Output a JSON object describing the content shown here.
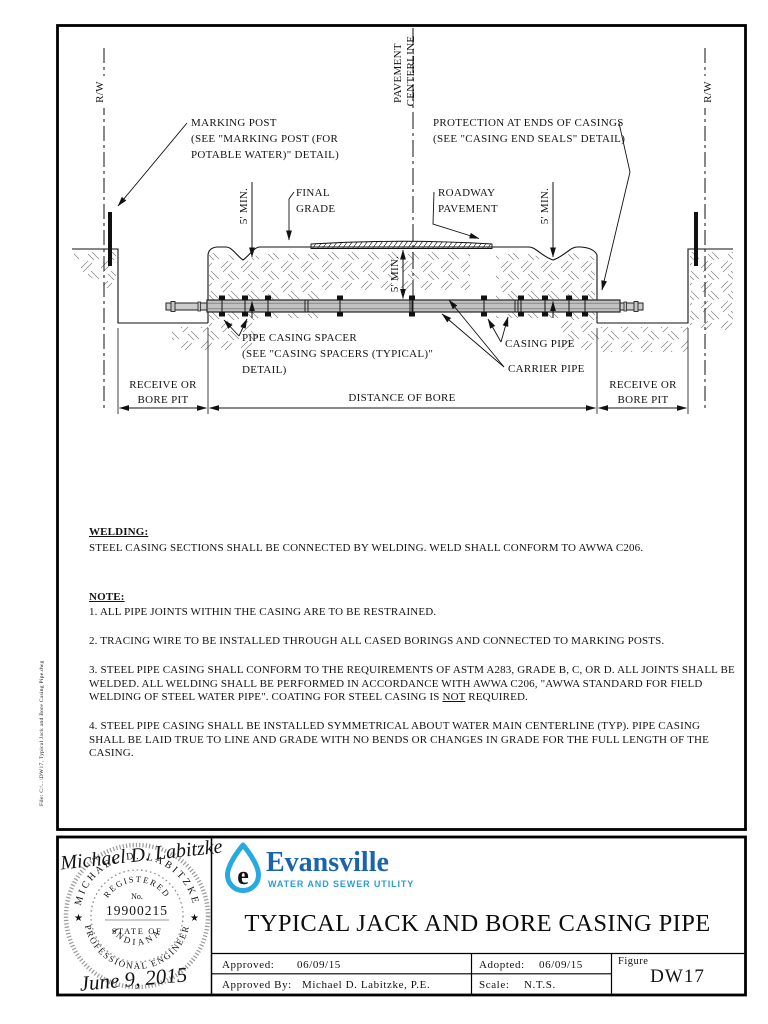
{
  "sheet": {
    "file_note": "File: C:\\...\\DW17, Typical Jack and Bore Casing Pipe.dwg"
  },
  "drawing": {
    "labels": {
      "rw_left": "R/W",
      "rw_right": "R/W",
      "pavement_cl_line1": "PAVEMENT",
      "pavement_cl_line2": "CENTERLINE",
      "marking_post": [
        "MARKING POST",
        "(SEE \"MARKING POST (FOR",
        "POTABLE WATER)\" DETAIL)"
      ],
      "protection": [
        "PROTECTION AT ENDS OF CASINGS",
        "(SEE \"CASING END SEALS\" DETAIL)"
      ],
      "five_min_left": "5' MIN.",
      "five_min_center": "5' MIN.",
      "five_min_right": "5' MIN.",
      "final_grade": [
        "FINAL",
        "GRADE"
      ],
      "roadway_pavement": [
        "ROADWAY",
        "PAVEMENT"
      ],
      "pipe_casing_spacer": [
        "PIPE CASING SPACER",
        "(SEE \"CASING SPACERS (TYPICAL)\"",
        "DETAIL)"
      ],
      "casing_pipe": "CASING PIPE",
      "carrier_pipe": "CARRIER PIPE",
      "receive_left": [
        "RECEIVE OR",
        "BORE PIT"
      ],
      "distance_of_bore": "DISTANCE OF BORE",
      "receive_right": [
        "RECEIVE OR",
        "BORE PIT"
      ]
    }
  },
  "notes": {
    "welding_heading": "WELDING:",
    "welding_body": "STEEL CASING SECTIONS SHALL BE CONNECTED BY WELDING. WELD SHALL CONFORM TO AWWA C206.",
    "note_heading": "NOTE:",
    "note1": "1. ALL PIPE JOINTS WITHIN THE CASING ARE TO BE RESTRAINED.",
    "note2": "2. TRACING WIRE TO BE INSTALLED THROUGH ALL CASED BORINGS AND CONNECTED TO MARKING POSTS.",
    "note3_pre": "3. STEEL PIPE CASING SHALL CONFORM TO THE REQUIREMENTS OF ASTM A283, GRADE B, C, OR D. ALL JOINTS SHALL BE WELDED. ALL WELDING SHALL BE PERFORMED IN ACCORDANCE WITH AWWA C206, \"AWWA STANDARD FOR FIELD WELDING OF STEEL WATER PIPE\". COATING FOR STEEL CASING IS ",
    "note3_underlined": "NOT",
    "note3_post": " REQUIRED.",
    "note4": "4. STEEL PIPE CASING SHALL BE INSTALLED SYMMETRICAL ABOUT WATER MAIN CENTERLINE (TYP). PIPE CASING SHALL BE LAID TRUE TO LINE AND GRADE WITH NO BENDS OR CHANGES IN GRADE FOR THE FULL LENGTH OF THE CASING."
  },
  "title_block": {
    "title": "TYPICAL JACK AND BORE CASING PIPE",
    "logo": {
      "name": "Evansville",
      "subtitle": "WATER AND SEWER UTILITY",
      "drop_letter": "e",
      "drop_color": "#29a9e1",
      "name_color": "#1a63ad",
      "subtitle_color": "#2b9cd8"
    },
    "approved_label": "Approved:",
    "approved_value": "06/09/15",
    "approved_by_label": "Approved By:",
    "approved_by_value": "Michael D. Labitzke, P.E.",
    "adopted_label": "Adopted:",
    "adopted_value": "06/09/15",
    "scale_label": "Scale:",
    "scale_value": "N.T.S.",
    "figure_label": "Figure",
    "figure_value": "DW17"
  },
  "seal": {
    "name_arc": "MICHAEL D. LABITZKE",
    "title_arc": "PROFESSIONAL ENGINEER",
    "registered": "REGISTERED",
    "no_label": "No.",
    "number": "19900215",
    "state_of": "STATE OF",
    "state": "INDIANA",
    "star_left": "★",
    "star_right": "★",
    "signature": "Michael D. Labitzke",
    "date": "June 9, 2015"
  }
}
